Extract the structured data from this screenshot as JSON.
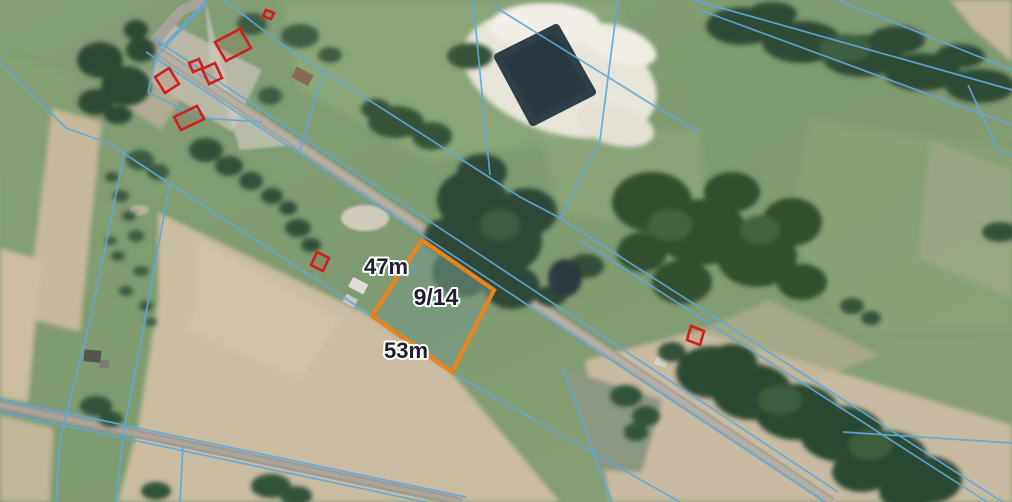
{
  "map": {
    "type": "aerial-cadastral-view",
    "highlighted_parcel": {
      "id_label": "9/14",
      "front_dimension_label": "47m",
      "side_dimension_label": "53m",
      "outline_color": "#e8831d"
    },
    "overlay_colors": {
      "cadastral_boundary_line": "#5fa8dc",
      "building_outline": "#cf1f1f",
      "dimension_text": "#1e1e30",
      "dimension_text_halo": "#ffffff"
    }
  }
}
